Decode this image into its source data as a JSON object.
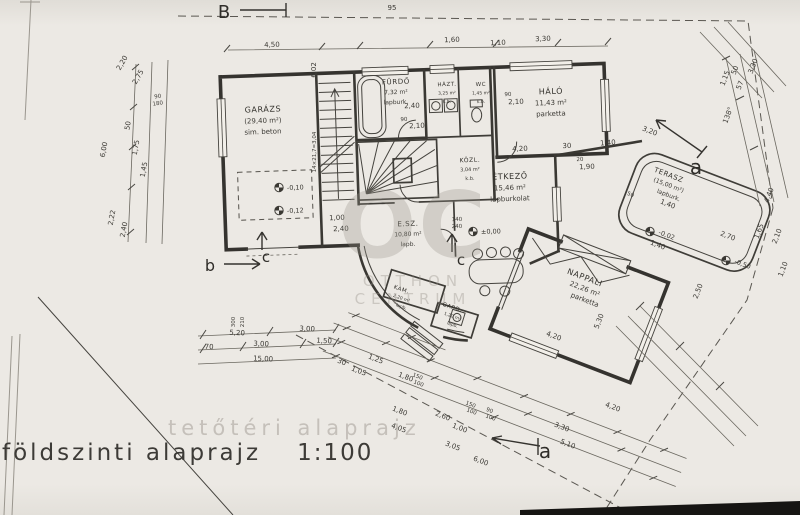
{
  "title": {
    "text": "földszinti alaprajz",
    "scale": "1:100",
    "ghost": "tetőtéri alaprajz"
  },
  "watermark": {
    "logo": "OC",
    "line1": "OTTHON",
    "line2": "CENTRUM"
  },
  "colors": {
    "ink": "#35332f",
    "dim_text": "#3c3a35",
    "paper": "#eae7e2",
    "watermark": "#969189"
  },
  "rooms": [
    {
      "id": "garazs",
      "name": "GARÁZS",
      "area": "(29,40 m²)",
      "finish": "sim. beton",
      "x": 263,
      "y": 112,
      "r": -2,
      "fs": 8
    },
    {
      "id": "furdo",
      "name": "FÜRDŐ",
      "area": "7,32 m²",
      "finish": "lapburk.",
      "x": 396,
      "y": 84,
      "r": -2,
      "fs": 7
    },
    {
      "id": "hazt",
      "name": "HÁZT.",
      "area": "3,25 m²",
      "finish": "k.b.",
      "x": 447,
      "y": 86,
      "r": -2,
      "fs": 5.5
    },
    {
      "id": "wc",
      "name": "WC",
      "area": "1,45 m²",
      "finish": "k.b.",
      "x": 481,
      "y": 86,
      "r": -2,
      "fs": 5.5
    },
    {
      "id": "kozl",
      "name": "KÖZL.",
      "area": "3,04 m²",
      "finish": "k.b.",
      "x": 470,
      "y": 162,
      "r": -2,
      "fs": 6
    },
    {
      "id": "halo",
      "name": "HÁLÓ",
      "area": "11,43 m²",
      "finish": "parketta",
      "x": 551,
      "y": 94,
      "r": -2,
      "fs": 8
    },
    {
      "id": "etkezo",
      "name": "ÉTKEZŐ",
      "area": "15,46 m²",
      "finish": "lapburkolat",
      "x": 510,
      "y": 179,
      "r": -2,
      "fs": 8
    },
    {
      "id": "esz",
      "name": "E.SZ.",
      "area": "10,80 m²",
      "finish": "lapb.",
      "x": 408,
      "y": 226,
      "r": -2,
      "fs": 7
    },
    {
      "id": "kam",
      "name": "KAM.",
      "area": "2,20 m²",
      "finish": "lapb.",
      "x": 401,
      "y": 291,
      "r": 19,
      "fs": 5.5
    },
    {
      "id": "gard",
      "name": "GARD.",
      "area": "1,20 m²",
      "finish": "lapb.",
      "x": 452,
      "y": 309,
      "r": 19,
      "fs": 5.5
    },
    {
      "id": "nappali",
      "name": "NAPPALI",
      "area": "22,26 m²",
      "finish": "parketta",
      "x": 584,
      "y": 280,
      "r": 21,
      "fs": 8
    },
    {
      "id": "terasz",
      "name": "TERASZ",
      "area": "(15,00 m²)",
      "finish": "lapburk.",
      "x": 668,
      "y": 177,
      "r": 21,
      "fs": 7
    }
  ],
  "dims": [
    {
      "t": "4,50",
      "x": 272,
      "y": 47,
      "r": -2
    },
    {
      "t": "6,02",
      "x": 316,
      "y": 70,
      "r": -90
    },
    {
      "t": "14×21,7=3,04",
      "x": 316,
      "y": 152,
      "r": -90,
      "fs": 5.5
    },
    {
      "t": "95",
      "x": 392,
      "y": 10,
      "r": 0
    },
    {
      "t": "1,60",
      "x": 452,
      "y": 42,
      "r": -2
    },
    {
      "t": "1,10",
      "x": 498,
      "y": 45,
      "r": -2
    },
    {
      "t": "3,30",
      "x": 543,
      "y": 41,
      "r": -2
    },
    {
      "t": "2,20",
      "x": 124,
      "y": 64,
      "r": -60
    },
    {
      "t": "2,75",
      "x": 140,
      "y": 78,
      "r": -60
    },
    {
      "t": "6,00",
      "x": 106,
      "y": 150,
      "r": -80
    },
    {
      "t": "50",
      "x": 130,
      "y": 126,
      "r": -80
    },
    {
      "t": "1,75",
      "x": 138,
      "y": 148,
      "r": -80
    },
    {
      "t": "1,45",
      "x": 146,
      "y": 170,
      "r": -80
    },
    {
      "t": "90",
      "x": 158,
      "y": 98,
      "r": -8,
      "fs": 5.5
    },
    {
      "t": "180",
      "x": 158,
      "y": 105,
      "r": -8,
      "fs": 5.5
    },
    {
      "t": "2,22",
      "x": 114,
      "y": 218,
      "r": -80
    },
    {
      "t": "2,40",
      "x": 126,
      "y": 230,
      "r": -80
    },
    {
      "t": "5,20",
      "x": 237,
      "y": 335,
      "r": 3
    },
    {
      "t": "3,00",
      "x": 307,
      "y": 331,
      "r": 3
    },
    {
      "t": "70",
      "x": 209,
      "y": 349,
      "r": 3
    },
    {
      "t": "3,00",
      "x": 261,
      "y": 346,
      "r": 3
    },
    {
      "t": "1,50",
      "x": 324,
      "y": 343,
      "r": 3
    },
    {
      "t": "15,00",
      "x": 263,
      "y": 361,
      "r": 3
    },
    {
      "t": "300",
      "x": 235,
      "y": 322,
      "r": -90,
      "fs": 5.5
    },
    {
      "t": "210",
      "x": 244,
      "y": 322,
      "r": -90,
      "fs": 5.5
    },
    {
      "t": "30",
      "x": 341,
      "y": 364,
      "r": 21
    },
    {
      "t": "1,05",
      "x": 358,
      "y": 373,
      "r": 21
    },
    {
      "t": "1,25",
      "x": 375,
      "y": 361,
      "r": 21
    },
    {
      "t": "1,80",
      "x": 405,
      "y": 379,
      "r": 21
    },
    {
      "t": "150",
      "x": 417,
      "y": 378,
      "r": 21,
      "fs": 5.5
    },
    {
      "t": "100",
      "x": 418,
      "y": 385,
      "r": 21,
      "fs": 5.5
    },
    {
      "t": "1,80",
      "x": 399,
      "y": 413,
      "r": 21
    },
    {
      "t": "2,60",
      "x": 442,
      "y": 418,
      "r": 21
    },
    {
      "t": "1,00",
      "x": 459,
      "y": 430,
      "r": 21
    },
    {
      "t": "3,05",
      "x": 452,
      "y": 448,
      "r": 21
    },
    {
      "t": "4,05",
      "x": 398,
      "y": 430,
      "r": 21
    },
    {
      "t": "150",
      "x": 470,
      "y": 406,
      "r": 21,
      "fs": 5.5
    },
    {
      "t": "100",
      "x": 471,
      "y": 413,
      "r": 21,
      "fs": 5.5
    },
    {
      "t": "90",
      "x": 489,
      "y": 412,
      "r": 21,
      "fs": 5.5
    },
    {
      "t": "100",
      "x": 490,
      "y": 419,
      "r": 21,
      "fs": 5.5
    },
    {
      "t": "3,30",
      "x": 561,
      "y": 429,
      "r": 21
    },
    {
      "t": "5,10",
      "x": 567,
      "y": 446,
      "r": 21
    },
    {
      "t": "6,00",
      "x": 480,
      "y": 463,
      "r": 21
    },
    {
      "t": "4,20",
      "x": 520,
      "y": 151,
      "r": -2
    },
    {
      "t": "30",
      "x": 567,
      "y": 148,
      "r": -2
    },
    {
      "t": "1,40",
      "x": 608,
      "y": 145,
      "r": -4
    },
    {
      "t": "20",
      "x": 580,
      "y": 161,
      "r": -2,
      "fs": 5.5
    },
    {
      "t": "1,90",
      "x": 587,
      "y": 169,
      "r": -2
    },
    {
      "t": "90",
      "x": 404,
      "y": 121,
      "r": -2,
      "fs": 5.5
    },
    {
      "t": "2,10",
      "x": 417,
      "y": 128,
      "r": -2
    },
    {
      "t": "90",
      "x": 508,
      "y": 96,
      "r": -2,
      "fs": 5.5
    },
    {
      "t": "2,10",
      "x": 516,
      "y": 104,
      "r": -2
    },
    {
      "t": "2,40",
      "x": 412,
      "y": 108,
      "r": -2
    },
    {
      "t": "1,00",
      "x": 337,
      "y": 220,
      "r": -2
    },
    {
      "t": "2,40",
      "x": 341,
      "y": 231,
      "r": -2
    },
    {
      "t": "140",
      "x": 457,
      "y": 221,
      "r": -2,
      "fs": 5.5
    },
    {
      "t": "240",
      "x": 457,
      "y": 228,
      "r": -2,
      "fs": 5.5
    },
    {
      "t": "4,20",
      "x": 553,
      "y": 338,
      "r": 21
    },
    {
      "t": "5,30",
      "x": 601,
      "y": 322,
      "r": -69
    },
    {
      "t": "4,20",
      "x": 612,
      "y": 409,
      "r": 21
    },
    {
      "t": "1,40",
      "x": 667,
      "y": 206,
      "r": 21
    },
    {
      "t": "3,20",
      "x": 649,
      "y": 133,
      "r": 21
    },
    {
      "t": "1,15",
      "x": 727,
      "y": 79,
      "r": -69
    },
    {
      "t": "50",
      "x": 737,
      "y": 71,
      "r": -69
    },
    {
      "t": "57",
      "x": 742,
      "y": 86,
      "r": -69
    },
    {
      "t": "3,30",
      "x": 755,
      "y": 67,
      "r": -69
    },
    {
      "t": "138°",
      "x": 730,
      "y": 116,
      "r": -69
    },
    {
      "t": "50",
      "x": 630,
      "y": 196,
      "r": 21,
      "fs": 5.5
    },
    {
      "t": "1,40",
      "x": 657,
      "y": 247,
      "r": 21
    },
    {
      "t": "2,70",
      "x": 727,
      "y": 238,
      "r": 21
    },
    {
      "t": "1,65",
      "x": 761,
      "y": 232,
      "r": -69
    },
    {
      "t": "4,40",
      "x": 771,
      "y": 196,
      "r": -69
    },
    {
      "t": "2,10",
      "x": 779,
      "y": 237,
      "r": -69
    },
    {
      "t": "1,10",
      "x": 785,
      "y": 270,
      "r": -69
    },
    {
      "t": "2,50",
      "x": 700,
      "y": 292,
      "r": -69
    }
  ],
  "levels": [
    {
      "t": "±0,00",
      "x": 486,
      "y": 234,
      "r": -2
    },
    {
      "t": "-0,10",
      "x": 292,
      "y": 190,
      "r": -2
    },
    {
      "t": "-0,12",
      "x": 292,
      "y": 213,
      "r": -2
    },
    {
      "t": "-0,02",
      "x": 663,
      "y": 234,
      "r": 21
    },
    {
      "t": "-0,50",
      "x": 739,
      "y": 263,
      "r": 21
    }
  ],
  "sections": [
    {
      "label": "B",
      "x": 224,
      "y": 18,
      "fs": 18
    },
    {
      "label": "b",
      "x": 210,
      "y": 271,
      "fs": 16
    },
    {
      "label": "c",
      "x": 266,
      "y": 262,
      "fs": 15
    },
    {
      "label": "c",
      "x": 461,
      "y": 265,
      "fs": 15
    },
    {
      "label": "a",
      "x": 696,
      "y": 174,
      "fs": 20
    },
    {
      "label": "a",
      "x": 545,
      "y": 458,
      "fs": 20
    }
  ]
}
